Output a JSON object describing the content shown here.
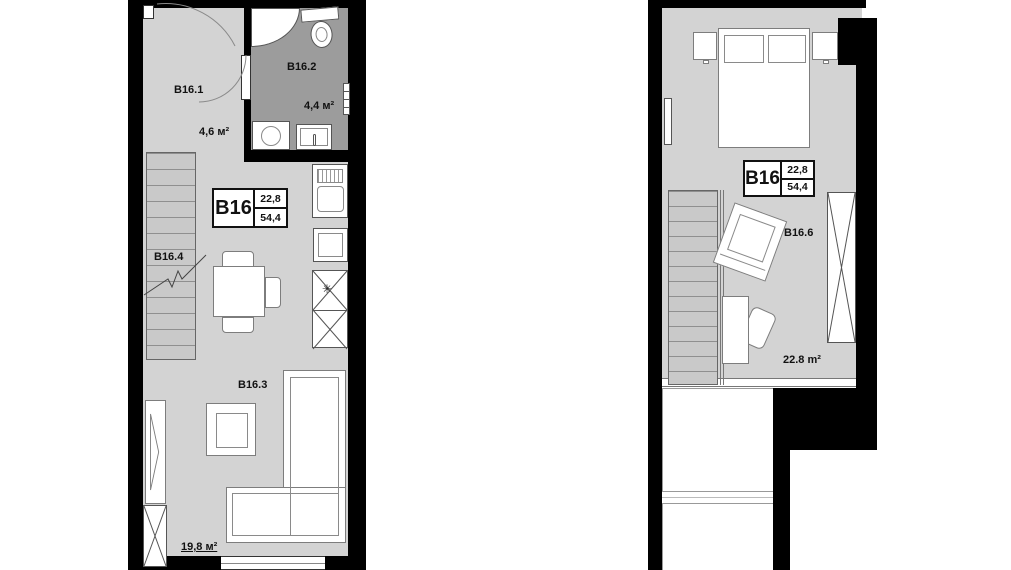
{
  "unit": {
    "name": "B16",
    "area_upper": "22,8",
    "area_total": "54,4"
  },
  "floor1": {
    "hallway": {
      "label": "B16.1",
      "area": "4,6 м²"
    },
    "bathroom": {
      "label": "B16.2",
      "area": "4,4 м²"
    },
    "living_room": {
      "label": "B16.3",
      "area": "19,8 м²"
    },
    "stairs": {
      "label": "B16.4"
    }
  },
  "floor2": {
    "bedroom": {
      "label": "B16.6",
      "area": "22.8 m²"
    }
  },
  "icons": {
    "fridge_star": "✳"
  },
  "colors": {
    "wall": "#000000",
    "floor": "#d3d3d3",
    "bathroom_floor": "#9c9c9c",
    "furniture_outline": "#7d7d7d",
    "text": "#111111"
  }
}
